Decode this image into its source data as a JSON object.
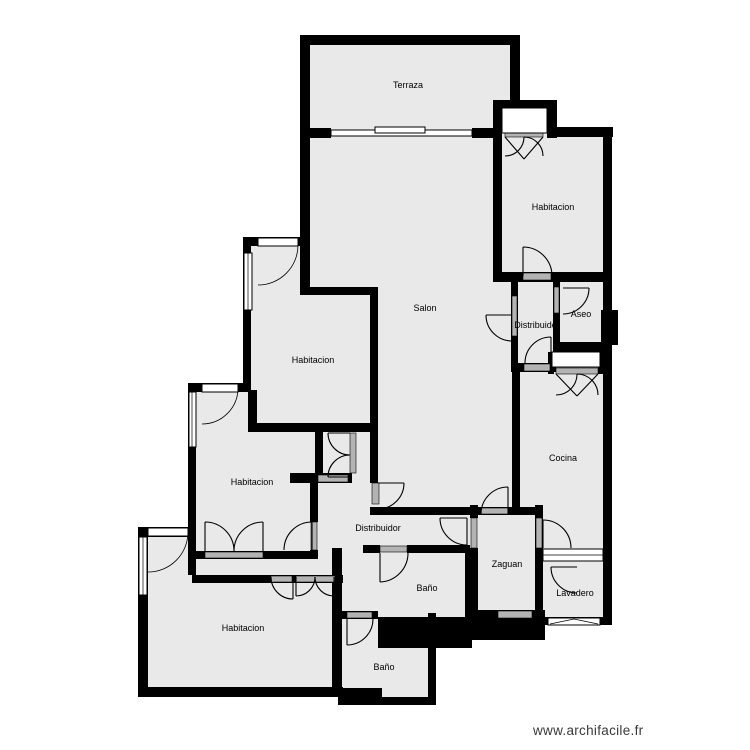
{
  "plan": {
    "source_label": "www.archifacile.fr"
  },
  "colors": {
    "floor": "#e9e9e9",
    "wall": "#000000",
    "sill": "#b3b3b3",
    "window": "#ffffff",
    "background": "#ffffff",
    "label": "#000000",
    "watermark": "#3a3a3a"
  },
  "rooms": [
    {
      "id": "terraza",
      "label": "Terraza"
    },
    {
      "id": "habitacion-tr",
      "label": "Habitacion"
    },
    {
      "id": "salon",
      "label": "Salon"
    },
    {
      "id": "habitacion-ml",
      "label": "Habitacion"
    },
    {
      "id": "aseo",
      "label": "Aseo"
    },
    {
      "id": "distribuidor-1",
      "label": "Distribuidor"
    },
    {
      "id": "cocina",
      "label": "Cocina"
    },
    {
      "id": "habitacion-l",
      "label": "Habitacion"
    },
    {
      "id": "distribuidor-2",
      "label": "Distribuidor"
    },
    {
      "id": "zaguan",
      "label": "Zaguan"
    },
    {
      "id": "lavadero",
      "label": "Lavadero"
    },
    {
      "id": "bano-1",
      "label": "Baño"
    },
    {
      "id": "habitacion-bl",
      "label": "Habitacion"
    },
    {
      "id": "bano-2",
      "label": "Baño"
    }
  ]
}
